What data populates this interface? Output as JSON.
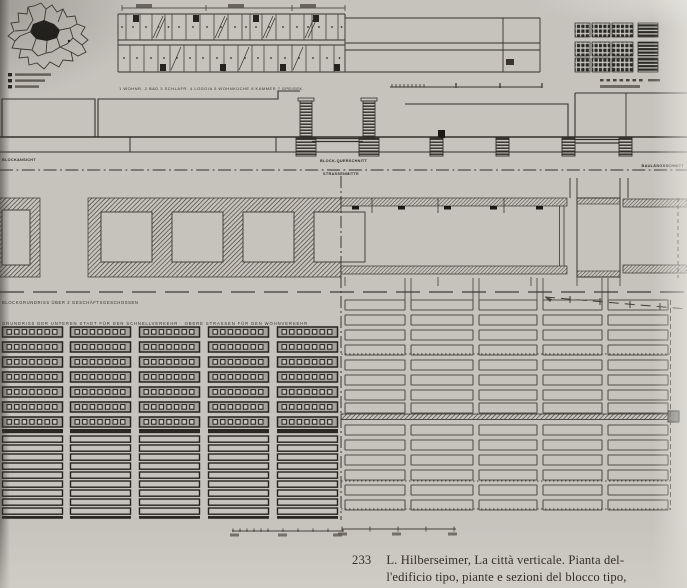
{
  "figure": {
    "caption_number": "233",
    "caption_line1": "L. Hilberseimer, La città verticale. Pianta del-",
    "caption_line2": "l'edificio tipo, piante e sezioni del blocco tipo,"
  },
  "labels": {
    "elevation_left": "BLOCKANSICHT",
    "section_cross": "BLOCK-QUERSCHNITT",
    "street_center": "STRASSENMITTE",
    "section_long": "BAULÄNGSSCHNITT",
    "plan_upper": "BLOCKGRUNDRISS ÜBER 2 GESCHÄFTSGESCHOSSEN",
    "plan_lower": "GRUNDRISS DER UNTEREN STADT FÜR DEN SCHNELLVERKEHR · OBERE STRASSEN FÜR DEN WOHNVERKEHR",
    "unit_legend": "1 WOHNR. 2 BAD 3 SCHLAFR. 4 LOGGIA 5 WOHNKÜCHE 6 KAMMER 7 SPEISEK."
  },
  "colors": {
    "page": "#c5c3bc",
    "ink_dark": "#26231e",
    "ink_mid": "#34302a",
    "ink_light": "#524e47",
    "caption_text": "#332e27"
  },
  "drawing": {
    "strip": {
      "upper_divs": [
        126,
        140,
        152,
        165,
        172,
        186,
        200,
        214,
        228,
        242,
        250,
        262,
        276,
        290,
        304,
        312,
        326,
        338
      ],
      "lower_divs": [
        130,
        144,
        158,
        170,
        184,
        196,
        210,
        224,
        238,
        252,
        264,
        278,
        292,
        306,
        320,
        334
      ],
      "stairs_upper": [
        133,
        193,
        253,
        313
      ],
      "stairs_lower": [
        160,
        220,
        280,
        334
      ],
      "diag_upper": [
        152,
        214,
        262,
        304
      ],
      "diag_lower": [
        170,
        238,
        292
      ],
      "dims": [
        136,
        228,
        300
      ],
      "scale": {
        "y": 87,
        "x0": 390,
        "x1": 542,
        "dense": [
          392,
          396,
          400,
          404,
          408,
          412,
          416,
          420,
          424
        ],
        "sparse": [
          456,
          500,
          542
        ]
      }
    },
    "site_plan": {
      "rows": [
        23,
        42,
        58
      ],
      "row_h": 14,
      "cols": [
        {
          "x": 575,
          "w": 15
        },
        {
          "x": 592,
          "w": 18
        },
        {
          "x": 612,
          "w": 21
        },
        {
          "x": 638,
          "w": 20,
          "striped": true
        }
      ],
      "scale": {
        "y": 79,
        "x0": 600,
        "dashes": 7
      }
    },
    "section": {
      "base_blocks": [
        430,
        496,
        562,
        619
      ],
      "tower_x": [
        300,
        363
      ]
    },
    "plan_band": {
      "cells_x": [
        101,
        172,
        243,
        314
      ],
      "doors_x": [
        352,
        398,
        444,
        490,
        536
      ],
      "strip_verts": [
        372,
        438,
        504
      ],
      "below_verts": [
        345,
        438,
        531,
        577,
        620
      ],
      "street_pairs": [
        405,
        473,
        537,
        602
      ]
    },
    "left_plan": {
      "cols": [
        2,
        70,
        139,
        208,
        277
      ],
      "col_w": 61,
      "upper_rows": [
        327,
        342,
        357,
        372,
        387,
        402,
        417
      ],
      "bar_h": 10,
      "cells_per_bar": 7,
      "divider_y": 429,
      "lower_rows": [
        436,
        445,
        454,
        463,
        472,
        481,
        490,
        499,
        508
      ],
      "lower_h": 6.2,
      "bottom_y": 516,
      "scale": {
        "y": 531,
        "x0": 232,
        "x1": 343,
        "ticks": [
          233,
          240,
          247,
          254,
          261,
          268,
          283,
          298,
          313,
          328,
          343
        ],
        "labels": [
          230,
          278,
          333
        ]
      }
    },
    "right_plan": {
      "cols": [
        [
          345,
          60
        ],
        [
          411,
          62
        ],
        [
          479,
          58
        ],
        [
          543,
          59
        ],
        [
          608,
          60
        ]
      ],
      "rows": [
        300,
        315,
        330,
        345,
        360,
        375,
        390,
        403,
        425,
        440,
        455,
        470,
        485,
        500
      ],
      "bar_h": 10,
      "dotted_ys": [
        354,
        481,
        509
      ],
      "heavy_y": 414,
      "scale": {
        "y": 529,
        "x0": 342,
        "x1": 456,
        "ticks": [
          342,
          370,
          398,
          426,
          454
        ],
        "labels": [
          338,
          392,
          448
        ]
      }
    }
  }
}
